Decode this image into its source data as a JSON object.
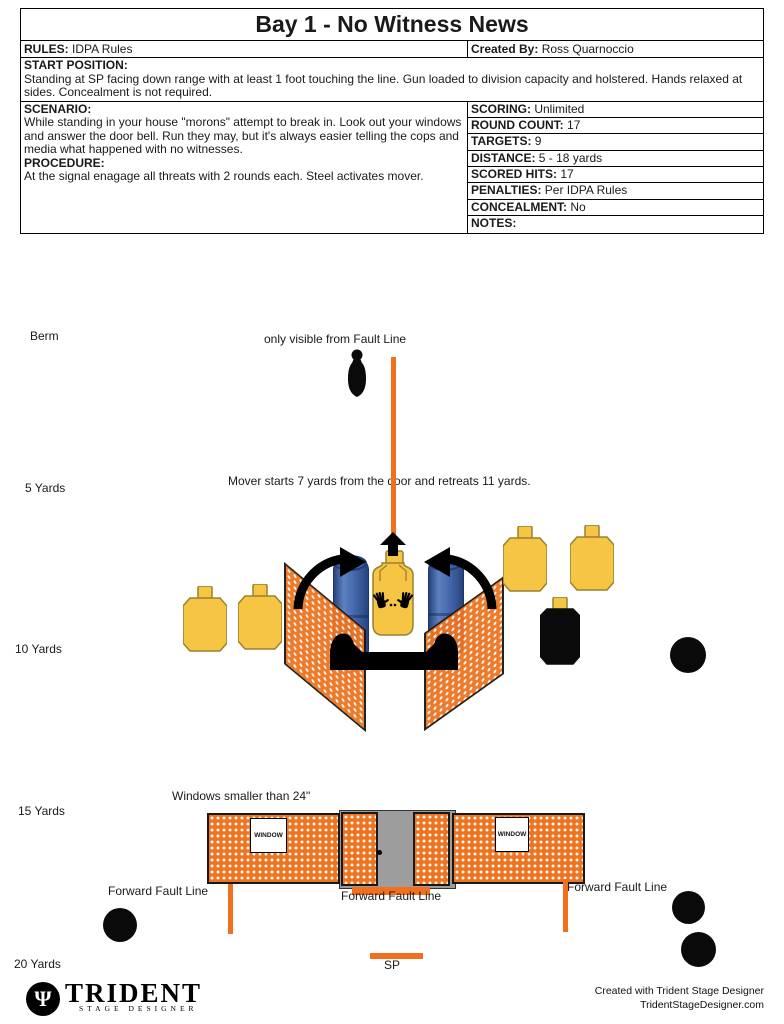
{
  "header": {
    "title": "Bay 1 - No Witness News",
    "rules_label": "RULES:",
    "rules_value": "IDPA Rules",
    "created_by_label": "Created By:",
    "created_by_value": "Ross Quarnoccio",
    "start_position_label": "START POSITION:",
    "start_position_text": "Standing at SP facing down range with at least 1 foot touching the line. Gun loaded to division capacity and holstered. Hands relaxed at sides. Concealment is not required.",
    "scenario_label": "SCENARIO:",
    "scenario_text": "While standing in your house \"morons\" attempt to break in. Look out your windows and answer the door bell. Run they may, but it's always easier telling the cops and media what happened with no witnesses.",
    "procedure_label": "PROCEDURE:",
    "procedure_text": "At the signal enagage all threats with 2 rounds each. Steel activates mover."
  },
  "stats": {
    "rows": [
      {
        "label": "SCORING:",
        "value": "Unlimited"
      },
      {
        "label": "ROUND COUNT:",
        "value": "17"
      },
      {
        "label": "TARGETS:",
        "value": "9"
      },
      {
        "label": "DISTANCE:",
        "value": "5 - 18 yards"
      },
      {
        "label": "SCORED HITS:",
        "value": "17"
      },
      {
        "label": "PENALTIES:",
        "value": "Per IDPA Rules"
      },
      {
        "label": "CONCEALMENT:",
        "value": "No"
      },
      {
        "label": "NOTES:",
        "value": ""
      }
    ]
  },
  "diagram": {
    "yard_labels": [
      "Berm",
      "5 Yards",
      "10 Yards",
      "15 Yards",
      "20 Yards"
    ],
    "notes": {
      "fault_visibility": "only visible from Fault Line",
      "mover": "Mover starts 7 yards from the door and retreats 11 yards.",
      "windows": "Windows smaller than 24\""
    },
    "fault_line_labels": {
      "left": "Forward Fault Line",
      "center": "Forward Fault Line",
      "right": "Forward Fault Line"
    },
    "sp_label": "SP",
    "window_label": "WINDOW",
    "icons": {
      "popper-silhouette-icon": "black steel popper silhouette",
      "idpa-target-icon": "tan cardboard target",
      "hardcover-target-icon": "black-painted target with tan head",
      "steel-plate-icon": "black round steel plate",
      "barrel-icon": "blue plastic barrel",
      "swing-arrow-icon": "black curved activation arrow",
      "mover-arrow-icon": "black up arrow on mover track",
      "hands-icon": "black handprints marking non-threat"
    },
    "colors": {
      "wall_orange": "#ED7421",
      "fault_line_orange": "#F26F1D",
      "target_yellow": "#F6C544",
      "barrel_blue": "#4A6BB0",
      "door_gray": "#9D9D9D",
      "steel_black": "#0A0A0A"
    }
  },
  "footer": {
    "logo_title": "TRIDENT",
    "logo_subtitle": "STAGE DESIGNER",
    "logo_glyph": "Ψ",
    "credit_line1": "Created with Trident Stage Designer",
    "credit_line2": "TridentStageDesigner.com"
  }
}
